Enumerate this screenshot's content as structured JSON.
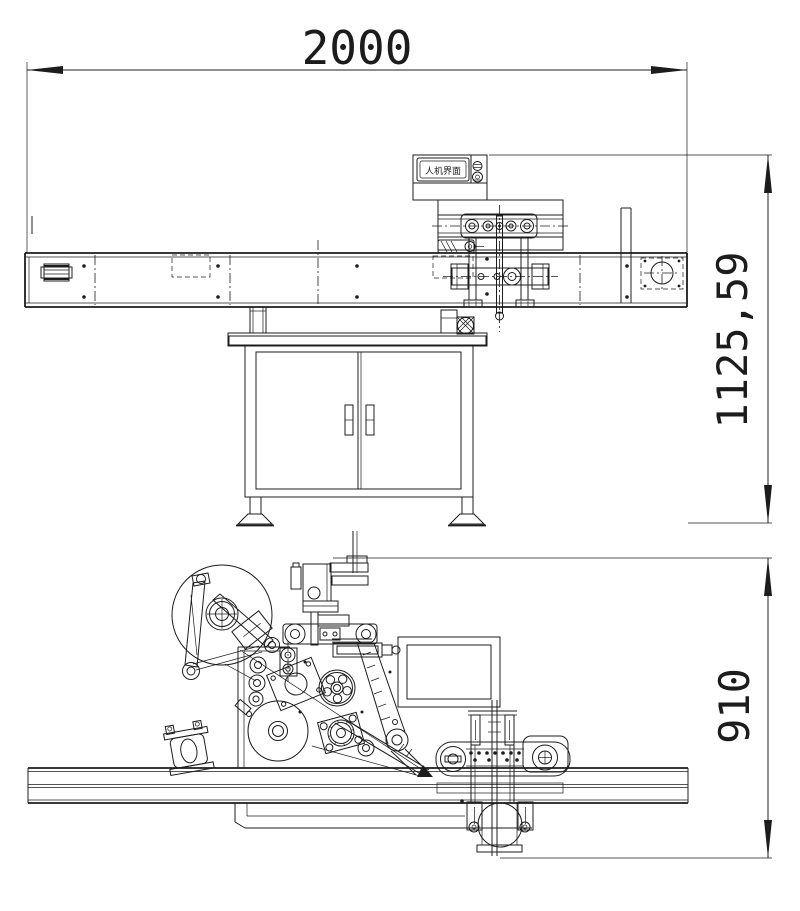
{
  "title": "labeling-machine-two-view-engineering-drawing",
  "colors": {
    "background": "#ffffff",
    "line": "#1c1c1c"
  },
  "top_view": {
    "dimension_length": "2000",
    "dimension_height": "1125,59",
    "hmi_label": "人机界面"
  },
  "bottom_view": {
    "dimension_depth": "910"
  }
}
